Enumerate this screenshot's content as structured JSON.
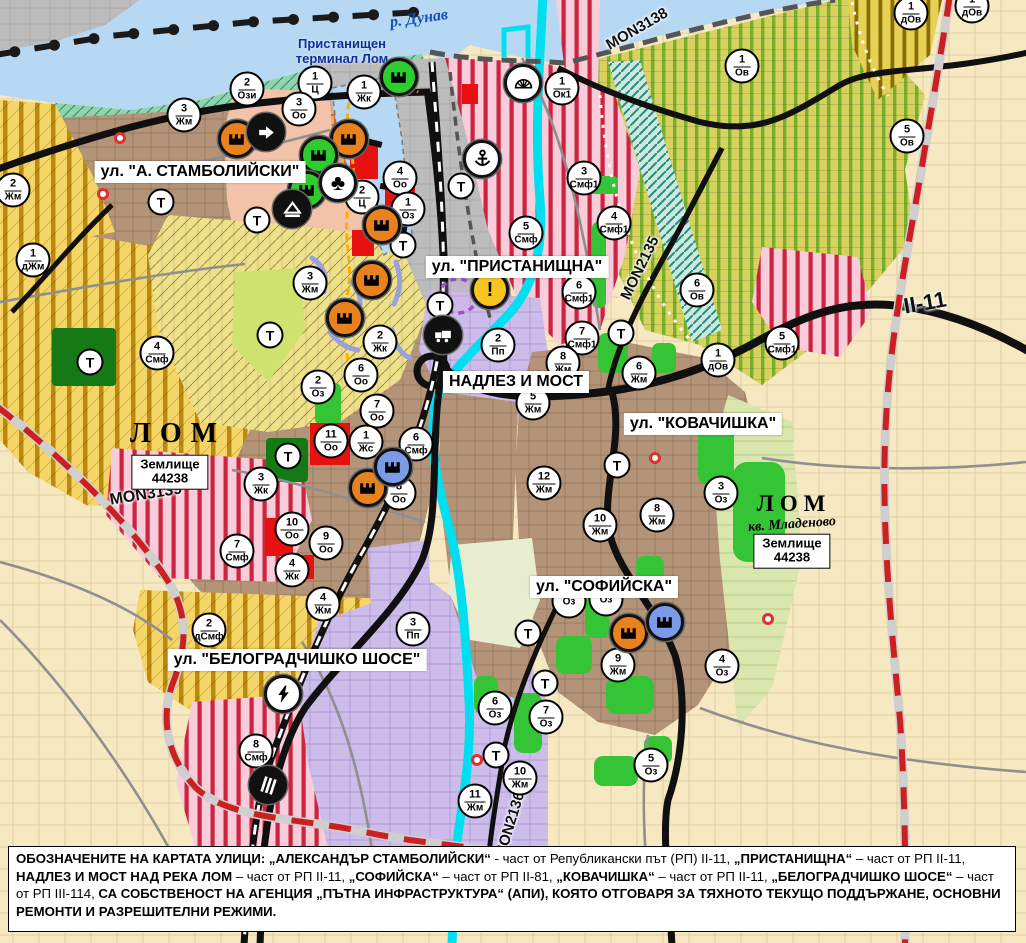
{
  "palette": {
    "water": "#b7d8f2",
    "river_lom": "#00dff0",
    "urban_brown": "#b49478",
    "agri_yellow_bars": "#f5d565",
    "vineyard_green": "#76b02a",
    "smf_pink": "#f8ccd8",
    "smf_red_stripe": "#cc2340",
    "industrial_lavender": "#ccbce9",
    "fields_beige": "#f6e8c0",
    "park_green": "#35c435",
    "dark_green": "#157a15",
    "port_grey": "#bcbcbc",
    "road_black": "#101010",
    "repair_road_red": "#cc2020",
    "warning_yellow": "#f7c51e",
    "factory_orange": "#e8821e",
    "factory_green": "#2ecc2e",
    "factory_blue": "#7b9be8"
  },
  "map": {
    "area_labels": [
      {
        "cls": "river-label",
        "name": "river-danube-label",
        "text": "р. Дунав",
        "x": 419,
        "y": 19,
        "rot": -8
      },
      {
        "cls": "terminal-label",
        "name": "port-terminal-label",
        "text": "Пристанищен\nтерминал Лом",
        "x": 342,
        "y": 51,
        "rot": 0
      },
      {
        "cls": "city-label-large",
        "name": "city-lom-label",
        "text": "ЛОМ",
        "x": 178,
        "y": 434,
        "rot": 0
      },
      {
        "cls": "city-label-small",
        "name": "city-lom-mladenovo-label",
        "text": "ЛОМ",
        "x": 794,
        "y": 504,
        "rot": 0
      },
      {
        "cls": "quarter-label",
        "name": "quarter-mladenovo-label",
        "text": "кв. Младеново",
        "x": 792,
        "y": 525,
        "rot": -4
      }
    ],
    "land_boxes": [
      {
        "line1": "Землище",
        "line2": "44238",
        "x": 170,
        "y": 472
      },
      {
        "line1": "Землище",
        "line2": "44238",
        "x": 792,
        "y": 551
      }
    ],
    "street_labels": [
      {
        "text": "ул. \"А. СТАМБОЛИЙСКИ\"",
        "x": 200,
        "y": 172
      },
      {
        "text": "ул. \"ПРИСТАНИЩНА\"",
        "x": 517,
        "y": 267
      },
      {
        "text": "НАДЛЕЗ И МОСТ",
        "x": 516,
        "y": 382
      },
      {
        "text": "ул. \"КОВАЧИШКА\"",
        "x": 703,
        "y": 424
      },
      {
        "text": "ул. \"СОФИЙСКА\"",
        "x": 604,
        "y": 587
      },
      {
        "text": "ул. \"БЕЛОГРАДЧИШКО ШОСЕ\"",
        "x": 297,
        "y": 660
      }
    ],
    "road_labels": [
      {
        "text": "MON3138",
        "x": 637,
        "y": 29,
        "rot": -30,
        "size": 15
      },
      {
        "text": "MON2135",
        "x": 640,
        "y": 268,
        "rot": -64,
        "size": 15
      },
      {
        "text": "MON3139",
        "x": 146,
        "y": 495,
        "rot": -9,
        "size": 16
      },
      {
        "text": "MON2136",
        "x": 510,
        "y": 825,
        "rot": -73,
        "size": 15
      },
      {
        "text": "II-11",
        "x": 925,
        "y": 303,
        "rot": -10,
        "size": 22
      }
    ],
    "zone_markers": [
      {
        "n": "2",
        "c": "Ози",
        "x": 247,
        "y": 89
      },
      {
        "n": "1",
        "c": "Ц",
        "x": 315,
        "y": 83
      },
      {
        "n": "3",
        "c": "Оо",
        "x": 299,
        "y": 109
      },
      {
        "n": "1",
        "c": "Жк",
        "x": 364,
        "y": 92
      },
      {
        "n": "3",
        "c": "Жм",
        "x": 184,
        "y": 115
      },
      {
        "n": "2",
        "c": "Жм",
        "x": 13,
        "y": 190
      },
      {
        "n": "1",
        "c": "дЖм",
        "x": 33,
        "y": 260
      },
      {
        "n": "4",
        "c": "Оо",
        "x": 400,
        "y": 178
      },
      {
        "n": "2",
        "c": "Ц",
        "x": 362,
        "y": 197
      },
      {
        "n": "1",
        "c": "Оз",
        "x": 408,
        "y": 209
      },
      {
        "n": "2",
        "c": "Жк",
        "x": 380,
        "y": 342
      },
      {
        "n": "3",
        "c": "Жм",
        "x": 310,
        "y": 283
      },
      {
        "n": "4",
        "c": "Смф",
        "x": 157,
        "y": 353
      },
      {
        "n": "2",
        "c": "Оз",
        "x": 318,
        "y": 387
      },
      {
        "n": "6",
        "c": "Оо",
        "x": 361,
        "y": 375
      },
      {
        "n": "7",
        "c": "Оо",
        "x": 377,
        "y": 411
      },
      {
        "n": "11",
        "c": "Оо",
        "x": 331,
        "y": 441
      },
      {
        "n": "1",
        "c": "Жс",
        "x": 366,
        "y": 442
      },
      {
        "n": "6",
        "c": "Смф",
        "x": 416,
        "y": 444
      },
      {
        "n": "8",
        "c": "Оо",
        "x": 399,
        "y": 493
      },
      {
        "n": "3",
        "c": "Жк",
        "x": 261,
        "y": 484
      },
      {
        "n": "10",
        "c": "Оо",
        "x": 292,
        "y": 529
      },
      {
        "n": "9",
        "c": "Оо",
        "x": 326,
        "y": 543
      },
      {
        "n": "4",
        "c": "Жк",
        "x": 292,
        "y": 570
      },
      {
        "n": "7",
        "c": "Смф",
        "x": 237,
        "y": 551
      },
      {
        "n": "4",
        "c": "Жм",
        "x": 323,
        "y": 604
      },
      {
        "n": "2",
        "c": "дСмф",
        "x": 209,
        "y": 630
      },
      {
        "n": "3",
        "c": "Пп",
        "x": 413,
        "y": 629
      },
      {
        "n": "8",
        "c": "Смф",
        "x": 256,
        "y": 751
      },
      {
        "n": "1",
        "c": "Ок1",
        "x": 562,
        "y": 88
      },
      {
        "n": "3",
        "c": "Смф1",
        "x": 584,
        "y": 178
      },
      {
        "n": "4",
        "c": "Смф1",
        "x": 614,
        "y": 223
      },
      {
        "n": "5",
        "c": "Смф",
        "x": 526,
        "y": 233
      },
      {
        "n": "6",
        "c": "Смф1",
        "x": 579,
        "y": 292
      },
      {
        "n": "7",
        "c": "Смф1",
        "x": 582,
        "y": 338
      },
      {
        "n": "5",
        "c": "Смф1",
        "x": 782,
        "y": 343
      },
      {
        "n": "1",
        "c": "Ов",
        "x": 742,
        "y": 66
      },
      {
        "n": "5",
        "c": "Ов",
        "x": 907,
        "y": 136
      },
      {
        "n": "1",
        "c": "дОв",
        "x": 911,
        "y": 13
      },
      {
        "n": "1",
        "c": "дОв",
        "x": 972,
        "y": 6
      },
      {
        "n": "6",
        "c": "Ов",
        "x": 697,
        "y": 290
      },
      {
        "n": "1",
        "c": "дОв",
        "x": 718,
        "y": 360
      },
      {
        "n": "2",
        "c": "Пп",
        "x": 498,
        "y": 345
      },
      {
        "n": "8",
        "c": "Жм",
        "x": 563,
        "y": 363
      },
      {
        "n": "5",
        "c": "Жм",
        "x": 533,
        "y": 403
      },
      {
        "n": "6",
        "c": "Жм",
        "x": 639,
        "y": 373
      },
      {
        "n": "12",
        "c": "Жм",
        "x": 544,
        "y": 483
      },
      {
        "n": "10",
        "c": "Жм",
        "x": 600,
        "y": 525
      },
      {
        "n": "8",
        "c": "Жм",
        "x": 657,
        "y": 515
      },
      {
        "n": "3",
        "c": "Оз",
        "x": 721,
        "y": 493
      },
      {
        "n": "9",
        "c": "Жм",
        "x": 618,
        "y": 665
      },
      {
        "n": "4",
        "c": "Оз",
        "x": 722,
        "y": 666
      },
      {
        "n": "",
        "c": "Оз",
        "x": 569,
        "y": 601
      },
      {
        "n": "",
        "c": "Оз",
        "x": 606,
        "y": 599
      },
      {
        "n": "6",
        "c": "Оз",
        "x": 495,
        "y": 708
      },
      {
        "n": "7",
        "c": "Оз",
        "x": 546,
        "y": 717
      },
      {
        "n": "5",
        "c": "Оз",
        "x": 651,
        "y": 765
      },
      {
        "n": "10",
        "c": "Жм",
        "x": 520,
        "y": 778
      },
      {
        "n": "11",
        "c": "Жм",
        "x": 475,
        "y": 801
      }
    ],
    "t_markers": [
      {
        "x": 90,
        "y": 362
      },
      {
        "x": 161,
        "y": 202
      },
      {
        "x": 257,
        "y": 220
      },
      {
        "x": 270,
        "y": 335
      },
      {
        "x": 288,
        "y": 456
      },
      {
        "x": 403,
        "y": 245
      },
      {
        "x": 440,
        "y": 305
      },
      {
        "x": 461,
        "y": 186
      },
      {
        "x": 528,
        "y": 633
      },
      {
        "x": 545,
        "y": 683
      },
      {
        "x": 496,
        "y": 755
      },
      {
        "x": 617,
        "y": 465
      },
      {
        "x": 621,
        "y": 333
      }
    ],
    "icon_markers": [
      {
        "t": "factory",
        "f": "orange",
        "x": 237,
        "y": 139
      },
      {
        "t": "factory",
        "f": "orange",
        "x": 349,
        "y": 139
      },
      {
        "t": "factory",
        "f": "orange",
        "x": 382,
        "y": 225
      },
      {
        "t": "factory",
        "f": "orange",
        "x": 372,
        "y": 280
      },
      {
        "t": "factory",
        "f": "orange",
        "x": 345,
        "y": 318
      },
      {
        "t": "factory",
        "f": "orange",
        "x": 368,
        "y": 488
      },
      {
        "t": "factory",
        "f": "orange",
        "x": 629,
        "y": 633
      },
      {
        "t": "factory",
        "f": "green",
        "x": 399,
        "y": 77
      },
      {
        "t": "factory",
        "f": "green",
        "x": 319,
        "y": 155
      },
      {
        "t": "factory",
        "f": "green",
        "x": 307,
        "y": 190
      },
      {
        "t": "factory",
        "f": "blue",
        "x": 393,
        "y": 467
      },
      {
        "t": "factory",
        "f": "blue",
        "x": 665,
        "y": 622
      },
      {
        "t": "arrow",
        "x": 266,
        "y": 132
      },
      {
        "t": "mountain",
        "x": 292,
        "y": 209
      },
      {
        "t": "club",
        "x": 338,
        "y": 183
      },
      {
        "t": "anchor",
        "x": 482,
        "y": 159
      },
      {
        "t": "sun",
        "x": 523,
        "y": 83
      },
      {
        "t": "truck",
        "x": 443,
        "y": 335
      },
      {
        "t": "warning",
        "x": 490,
        "y": 290
      },
      {
        "t": "lightning",
        "x": 283,
        "y": 694
      },
      {
        "t": "railway",
        "x": 268,
        "y": 785
      },
      {
        "t": "dot",
        "x": 120,
        "y": 138
      },
      {
        "t": "dot",
        "x": 103,
        "y": 194
      },
      {
        "t": "dot",
        "x": 655,
        "y": 458
      },
      {
        "t": "dot",
        "x": 477,
        "y": 760
      },
      {
        "t": "dot",
        "x": 768,
        "y": 619
      }
    ]
  },
  "footer": {
    "segments": [
      {
        "b": true,
        "text": "ОБОЗНАЧЕНИТЕ НА КАРТАТА УЛИЦИ: „АЛЕКСАНДЪР СТАМБОЛИЙСКИ“"
      },
      {
        "b": false,
        "text": " - част от Републикански път (РП) II-11, "
      },
      {
        "b": true,
        "text": "„ПРИСТАНИЩНА“"
      },
      {
        "b": false,
        "text": " – част от РП II-11, "
      },
      {
        "b": true,
        "text": "НАДЛЕЗ И МОСТ НАД РЕКА ЛОМ"
      },
      {
        "b": false,
        "text": " – част от РП II-11, "
      },
      {
        "b": true,
        "text": "„СОФИЙСКА“"
      },
      {
        "b": false,
        "text": " – част от РП II-81, "
      },
      {
        "b": true,
        "text": "„КОВАЧИШКА“"
      },
      {
        "b": false,
        "text": " – част от РП II-11, "
      },
      {
        "b": true,
        "text": "„БЕЛОГРАДЧИШКО ШОСЕ“"
      },
      {
        "b": false,
        "text": " – част от РП III-114, "
      },
      {
        "b": true,
        "text": "СА СОБСТВЕНОСТ НА АГЕНЦИЯ „ПЪТНА ИНФРАСТРУКТУРА“ (АПИ), КОЯТО ОТГОВАРЯ ЗА ТЯХНОТО ТЕКУЩО ПОДДЪРЖАНЕ, ОСНОВНИ РЕМОНТИ И РАЗРЕШИТЕЛНИ РЕЖИМИ."
      }
    ]
  }
}
